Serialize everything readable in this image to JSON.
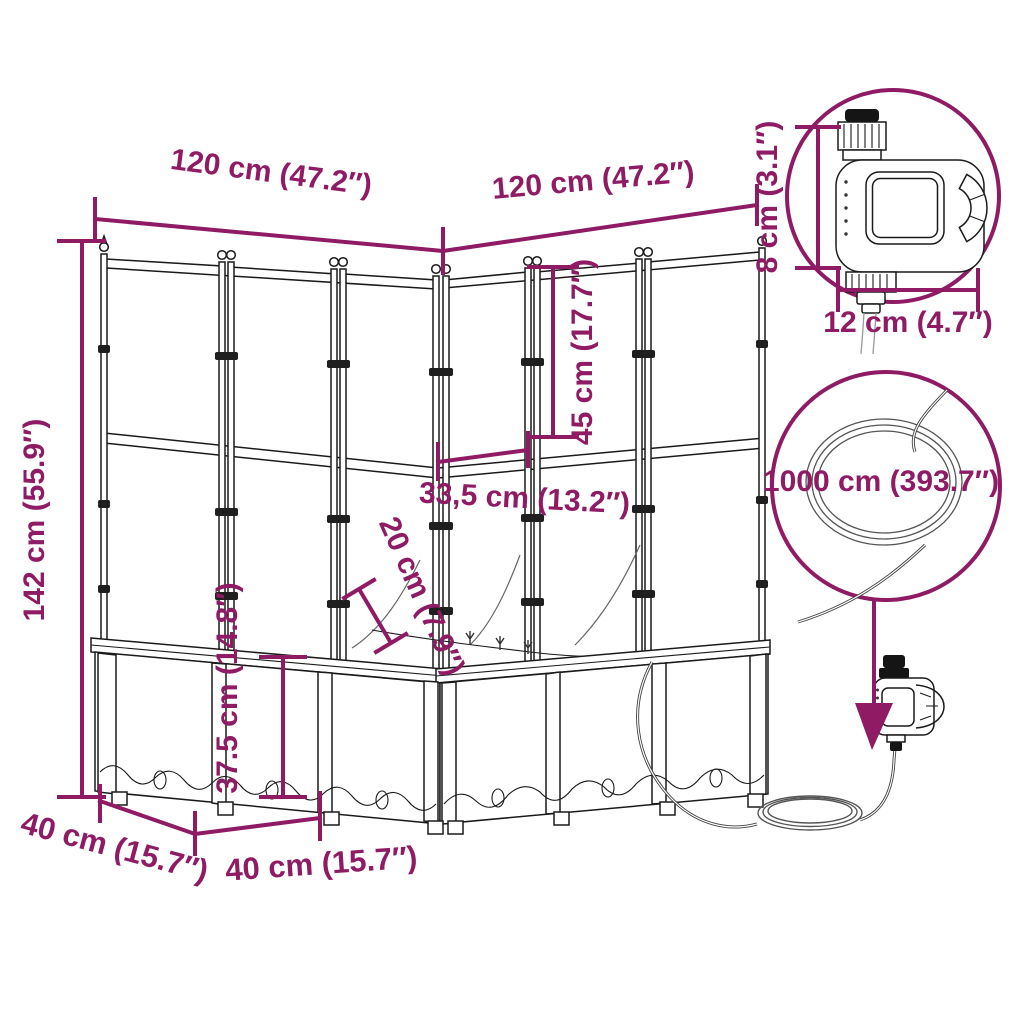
{
  "diagram": {
    "type": "product-dimension-diagram",
    "subject": "L-shaped garden planter with trellis, watering timer and hose",
    "accent_color": "#8e1b64",
    "line_color": "#1a1a1a",
    "labels": {
      "width_left": "120 cm (47.2″)",
      "width_right": "120 cm (47.2″)",
      "total_height": "142 cm (55.9″)",
      "trellis_height": "45 cm (17.7″)",
      "inner_width": "33,5 cm (13.2″)",
      "inner_gap": "20 cm (7.9″)",
      "planter_height": "37.5 cm (14.8″)",
      "depth_left": "40 cm (15.7″)",
      "depth_front": "40 cm (15.7″)",
      "timer_height": "8 cm (3.1″)",
      "timer_width": "12 cm (4.7″)",
      "hose_length": "1000 cm (393.7″)"
    }
  }
}
